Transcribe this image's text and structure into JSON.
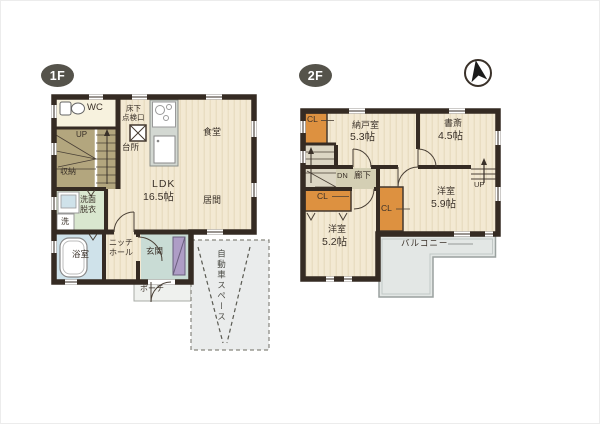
{
  "colors": {
    "wall": "#352b23",
    "floor_wood": "#f3e9d3",
    "floor_stripe": "#e8dcc0",
    "cream_room": "#f7f2de",
    "stairs_1f": "#b3a67e",
    "washroom_green": "#d9e7cf",
    "bath_blue": "#cfe2ea",
    "entry_teal": "#c9dcd5",
    "mat_purple": "#ae9dc6",
    "counter_gray": "#d3d8d2",
    "closet_orange": "#dd9140",
    "corridor_2f": "#d4cfb4",
    "balcony_gray": "#e3e7e5",
    "parking_gray": "#eaecec",
    "badge_bg": "#55534b",
    "text": "#3a3129"
  },
  "f1": {
    "badge": "1F",
    "labels": {
      "wc": "WC",
      "up": "UP",
      "closet": "収納",
      "washroom_1": "洗面",
      "washroom_2": "脱衣",
      "washer": "洗",
      "bath": "浴室",
      "niche_1": "ニッチ",
      "niche_2": "ホール",
      "entry": "玄関",
      "porch": "ポーチ",
      "hatch_1": "床下",
      "hatch_2": "点検口",
      "kitchen": "台所",
      "ldk": "LDK",
      "ldk_size": "16.5帖",
      "dining": "食堂",
      "living": "居間",
      "parking": "自動車スペース"
    }
  },
  "f2": {
    "badge": "2F",
    "labels": {
      "cl_top": "CL",
      "storage_room": "納戸室",
      "storage_size": "5.3帖",
      "study": "書斎",
      "study_size": "4.5帖",
      "dn": "DN",
      "hall": "廊下",
      "up": "UP",
      "cl_mid": "CL",
      "cl_center": "CL",
      "bedroom_a": "洋室",
      "bedroom_a_size": "5.9帖",
      "bedroom_b": "洋室",
      "bedroom_b_size": "5.2帖",
      "balcony": "バルコニー"
    }
  }
}
